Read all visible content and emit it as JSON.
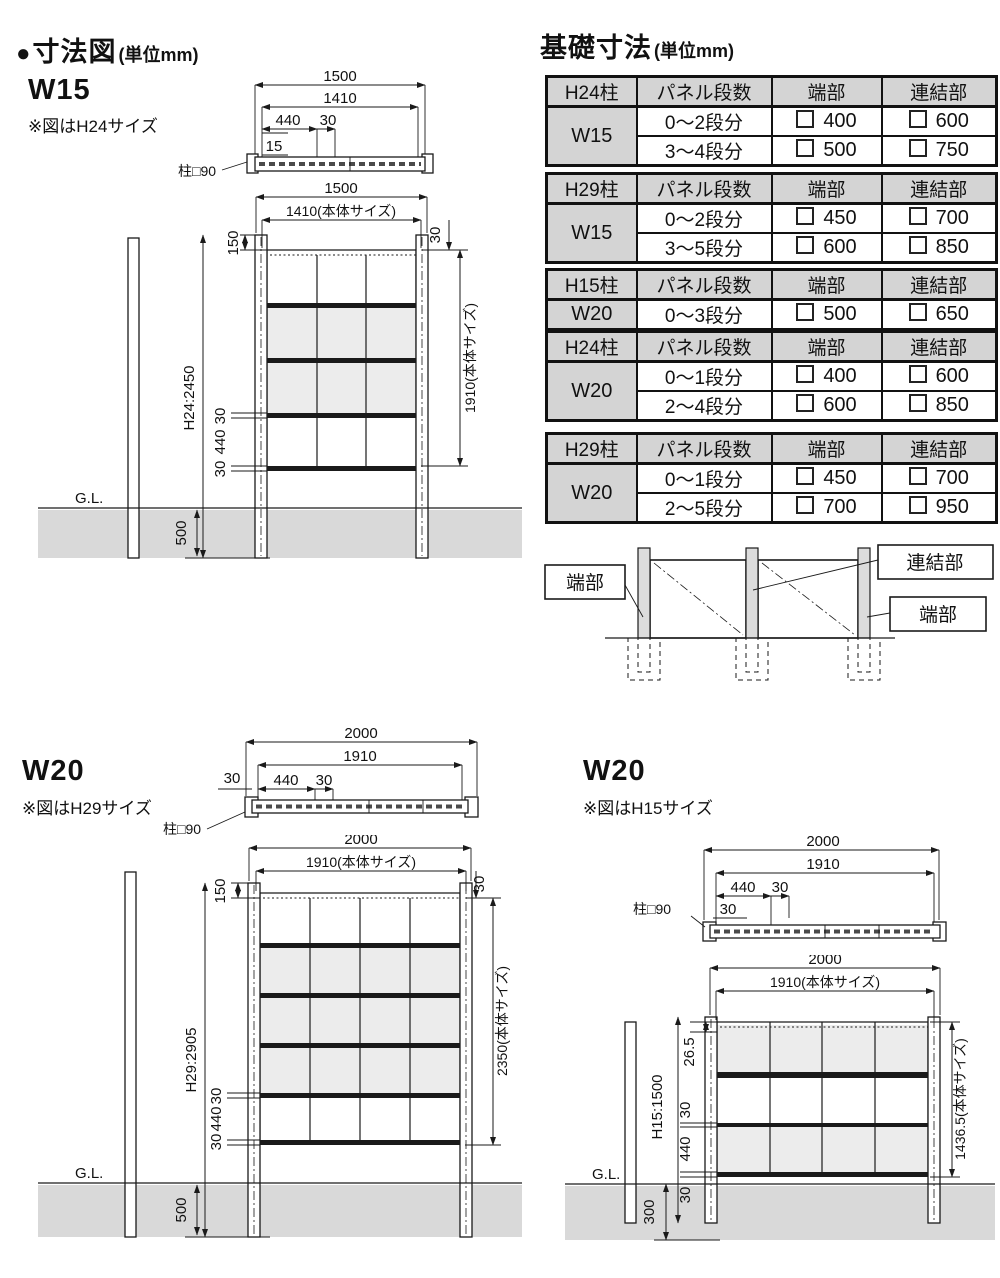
{
  "dimension_section": {
    "bullet": "●",
    "title": "寸法図",
    "unit": "(単位mm)",
    "w15": {
      "label": "W15",
      "note": "※図はH24サイズ",
      "post_note": "柱□90",
      "plan": {
        "overall": "1500",
        "body": "1410",
        "panel": "440",
        "bracket": "30",
        "offset": "15"
      },
      "elev": {
        "overall_w": "1500",
        "body_w": "1410(本体サイズ)",
        "top_offset": "150",
        "side_offset": "30",
        "height": "H24:2450",
        "body_h": "1910(本体サイズ)",
        "rail_a": "30",
        "panel_h": "440",
        "rail_b": "30",
        "gl": "G.L.",
        "embed": "500"
      }
    },
    "w20h29": {
      "label": "W20",
      "note": "※図はH29サイズ",
      "post_note": "柱□90",
      "plan": {
        "overall": "2000",
        "body": "1910",
        "panel": "440",
        "bracket": "30",
        "offset": "30"
      },
      "elev": {
        "overall_w": "2000",
        "body_w": "1910(本体サイズ)",
        "top_offset": "150",
        "side_offset": "30",
        "height": "H29:2905",
        "body_h": "2350(本体サイズ)",
        "rail_a": "30",
        "panel_h": "440",
        "rail_b": "30",
        "gl": "G.L.",
        "embed": "500"
      }
    },
    "w20h15": {
      "label": "W20",
      "note": "※図はH15サイズ",
      "post_note": "柱□90",
      "plan": {
        "overall": "2000",
        "body": "1910",
        "panel": "440",
        "bracket": "30",
        "offset": "30"
      },
      "elev": {
        "overall_w": "2000",
        "body_w": "1910(本体サイズ)",
        "top_offset": "26.5",
        "height": "H15:1500",
        "body_h": "1436.5(本体サイズ)",
        "rail_a": "30",
        "panel_h": "440",
        "rail_b": "30",
        "gl": "G.L.",
        "embed": "300"
      }
    }
  },
  "foundation_section": {
    "title": "基礎寸法",
    "unit": "(単位mm)",
    "col_headers": {
      "panel": "パネル段数",
      "end": "端部",
      "joint": "連結部"
    },
    "tables": [
      {
        "post": "H24柱",
        "width": "W15",
        "rows": [
          {
            "steps": "0〜2段分",
            "end": "400",
            "joint": "600"
          },
          {
            "steps": "3〜4段分",
            "end": "500",
            "joint": "750"
          }
        ]
      },
      {
        "post": "H29柱",
        "width": "W15",
        "rows": [
          {
            "steps": "0〜2段分",
            "end": "450",
            "joint": "700"
          },
          {
            "steps": "3〜5段分",
            "end": "600",
            "joint": "850"
          }
        ]
      },
      {
        "post": "H15柱",
        "width": "W20",
        "rows": [
          {
            "steps": "0〜3段分",
            "end": "500",
            "joint": "650"
          }
        ]
      },
      {
        "post": "H24柱",
        "width": "W20",
        "rows": [
          {
            "steps": "0〜1段分",
            "end": "400",
            "joint": "600"
          },
          {
            "steps": "2〜4段分",
            "end": "600",
            "joint": "850"
          }
        ]
      },
      {
        "post": "H29柱",
        "width": "W20",
        "rows": [
          {
            "steps": "0〜1段分",
            "end": "450",
            "joint": "700"
          },
          {
            "steps": "2〜5段分",
            "end": "700",
            "joint": "950"
          }
        ]
      }
    ],
    "diagram": {
      "end_left": "端部",
      "joint": "連結部",
      "end_right": "端部"
    }
  },
  "colors": {
    "ground": "#d9d9d9",
    "panel_gray": "#ececec",
    "table_header": "#d4d4d4",
    "line": "#1a1a1a"
  }
}
